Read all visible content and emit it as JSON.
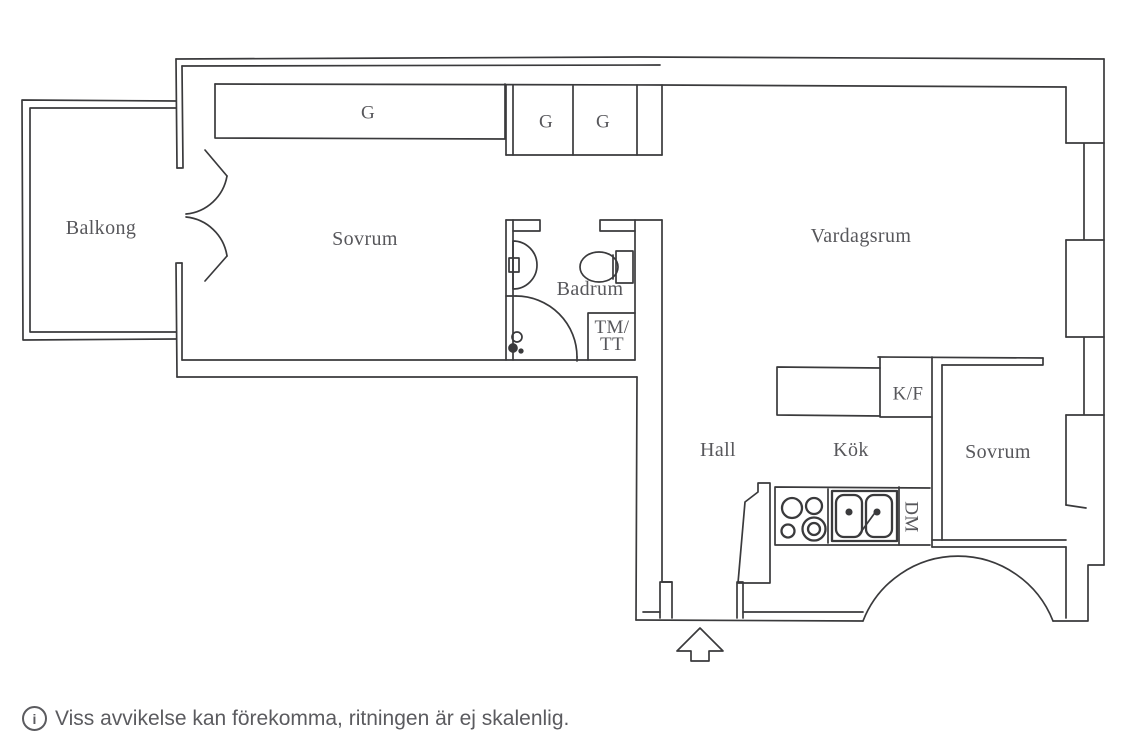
{
  "plan_title": "apartment-floor-plan",
  "colors": {
    "wall": "#3a3a3c",
    "label": "#57575b",
    "footer": "#5b5b5f",
    "background": "#ffffff"
  },
  "rooms": {
    "balkong": {
      "label": "Balkong"
    },
    "sovrum1": {
      "label": "Sovrum"
    },
    "badrum": {
      "label": "Badrum"
    },
    "vardagsrum": {
      "label": "Vardagsrum"
    },
    "hall": {
      "label": "Hall"
    },
    "kok": {
      "label": "Kök"
    },
    "sovrum2": {
      "label": "Sovrum"
    }
  },
  "fixtures": {
    "wardrobe": {
      "label": "G"
    },
    "closet1": {
      "label": "G"
    },
    "closet2": {
      "label": "G"
    },
    "washer_dryer": {
      "line1": "TM/",
      "line2": "TT"
    },
    "fridge_freezer": {
      "label": "K/F"
    },
    "dishwasher": {
      "label": "DM"
    }
  },
  "footer": {
    "icon_glyph": "i",
    "text": "Viss avvikelse kan förekomma, ritningen är ej skalenlig."
  }
}
